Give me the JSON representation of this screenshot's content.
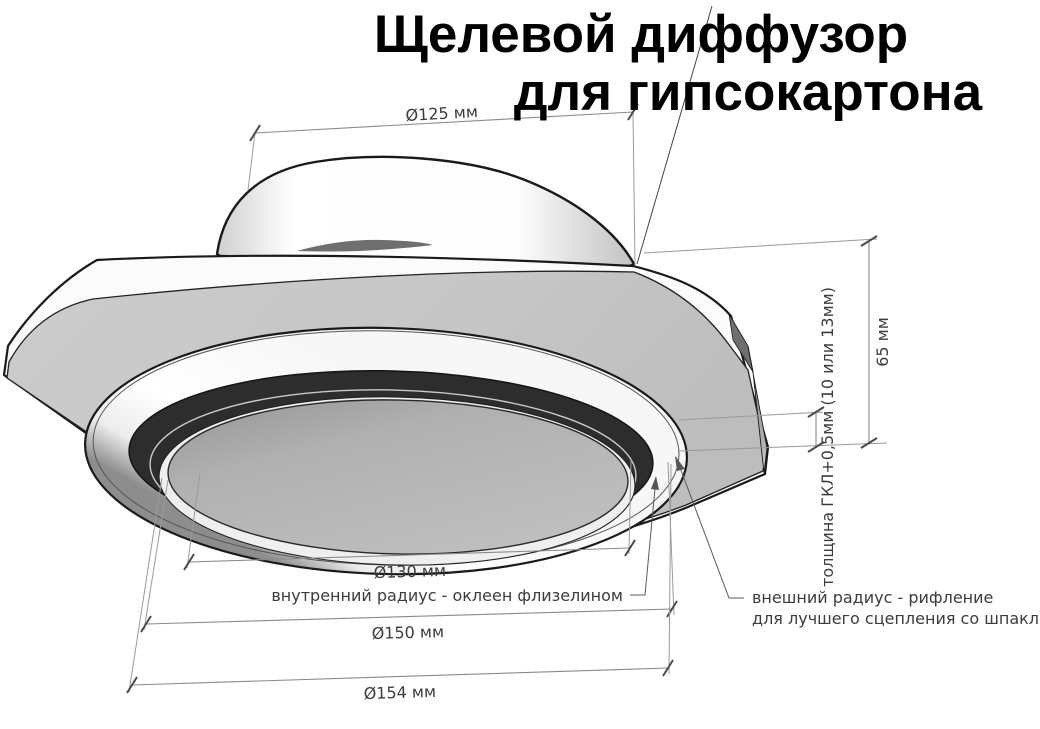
{
  "title": {
    "line1": "Щелевой диффузор",
    "line2": "для гипсокартона"
  },
  "dimensions": {
    "collar_diameter": "Ø125 мм",
    "height": "65 мм",
    "plate_thickness": "толщина ГКЛ+0,5мм (10 или 13мм)",
    "inner_diameter": "Ø130 мм",
    "outer_diameter": "Ø150 мм",
    "overall_diameter": "Ø154 мм"
  },
  "annotations": {
    "inner_radius_note": "внутренний радиус - оклеен флизелином",
    "outer_radius_note_line1": "внешний радиус - рифление",
    "outer_radius_note_line2": "для лучшего сцепления со шпаклёвкой"
  },
  "colors": {
    "outline": "#1a1a1a",
    "plate_face": "#c6c6c6",
    "slot_ring": "#2d2d2d",
    "dim_line": "#8a8a8a",
    "dim_text": "#3c3c3c"
  }
}
